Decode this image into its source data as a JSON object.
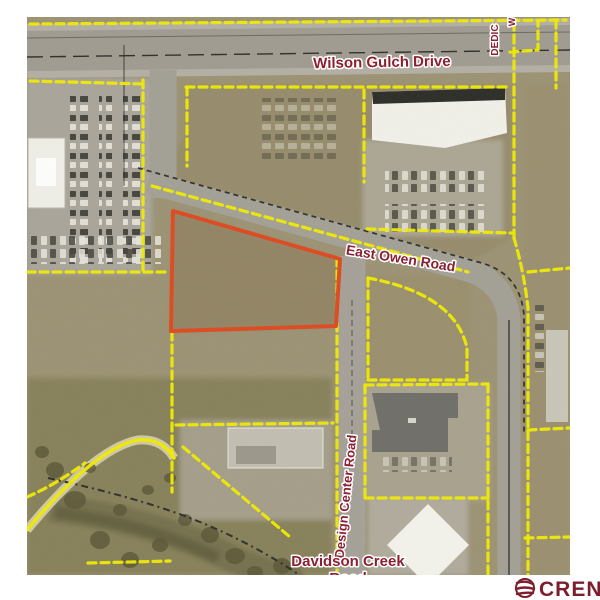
{
  "map": {
    "labels": {
      "wilson_gulch": "Wilson Gulch Drive",
      "east_owen": "East Owen Road",
      "design_center": "Design Center Road",
      "davidson_creek": "Davidson Creek",
      "davidson_creek_road": "Road",
      "dedication_partial": "DEDIC",
      "dedication_partial_2": "W"
    }
  },
  "logo": {
    "text": "CREN"
  },
  "colors": {
    "parcel_boundary": "#f0ec00",
    "subject_parcel": "#dd4a20",
    "road_label": "#8b2031",
    "logo": "#7d1e2c",
    "terrain": "#9c9274",
    "road": "#a3a096"
  }
}
